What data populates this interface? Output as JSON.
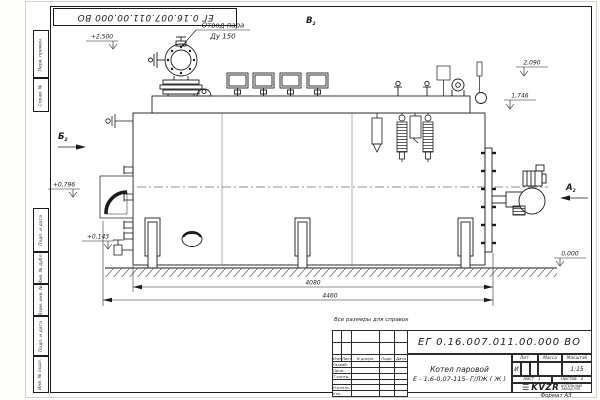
{
  "frame": {
    "top_stamp": "ЕГ 0.16.007.011.00.000 ВО",
    "format_note": "Формат А3"
  },
  "side_stamps": {
    "s1": "Перв. примен.",
    "s2": "Справ. №",
    "s3": "Подп. и дата",
    "s4": "Инв. № дубл.",
    "s5": "Взам. инв. №",
    "s6": "Подп. и дата",
    "s7": "Инв. № подл."
  },
  "annotations": {
    "steam_line1": "Отвод пара",
    "steam_line2": "Ду 150",
    "view_b_top": "В",
    "view_b_left": "Б",
    "view_a_right": "А",
    "view_sub": "2",
    "elev_2500": "+2,500",
    "elev_2090": "2,090",
    "elev_1746": "1,746",
    "elev_0796": "+0,796",
    "elev_0143": "+0,143",
    "elev_0000": "0,000",
    "dim_4080": "4080",
    "dim_4460": "4460",
    "note": "Все размеры для справок"
  },
  "title_block": {
    "doc_number": "ЕГ 0.16.007.011.00.000 ВО",
    "product_line1": "Котел паровой",
    "product_line2": "Е - 1,6-0,07-115- Г/ЛЖ ( Ж )",
    "col_izm": "Изм.",
    "col_list": "Лист",
    "col_doc": "N докум.",
    "col_sign": "Подп.",
    "col_date": "Дата",
    "row_developed": "Разраб.",
    "row_checked": "Пров.",
    "row_tcontrol": "Т.контр.",
    "row_ncontrol": "Н.контр.",
    "row_approved": "Утв.",
    "lit_label": "Лит.",
    "lit_value": "И",
    "mass_label": "Масса",
    "scale_label": "Масштаб",
    "scale_value": "1:15",
    "sheet_label": "Лист",
    "sheet_value": "1",
    "sheets_label": "Листов",
    "sheets_value": "2",
    "logo_text": "KVZR",
    "company_line1": "КОТЕЛЬНЫЙ",
    "company_line2": "ЗАВОД РЭП"
  }
}
